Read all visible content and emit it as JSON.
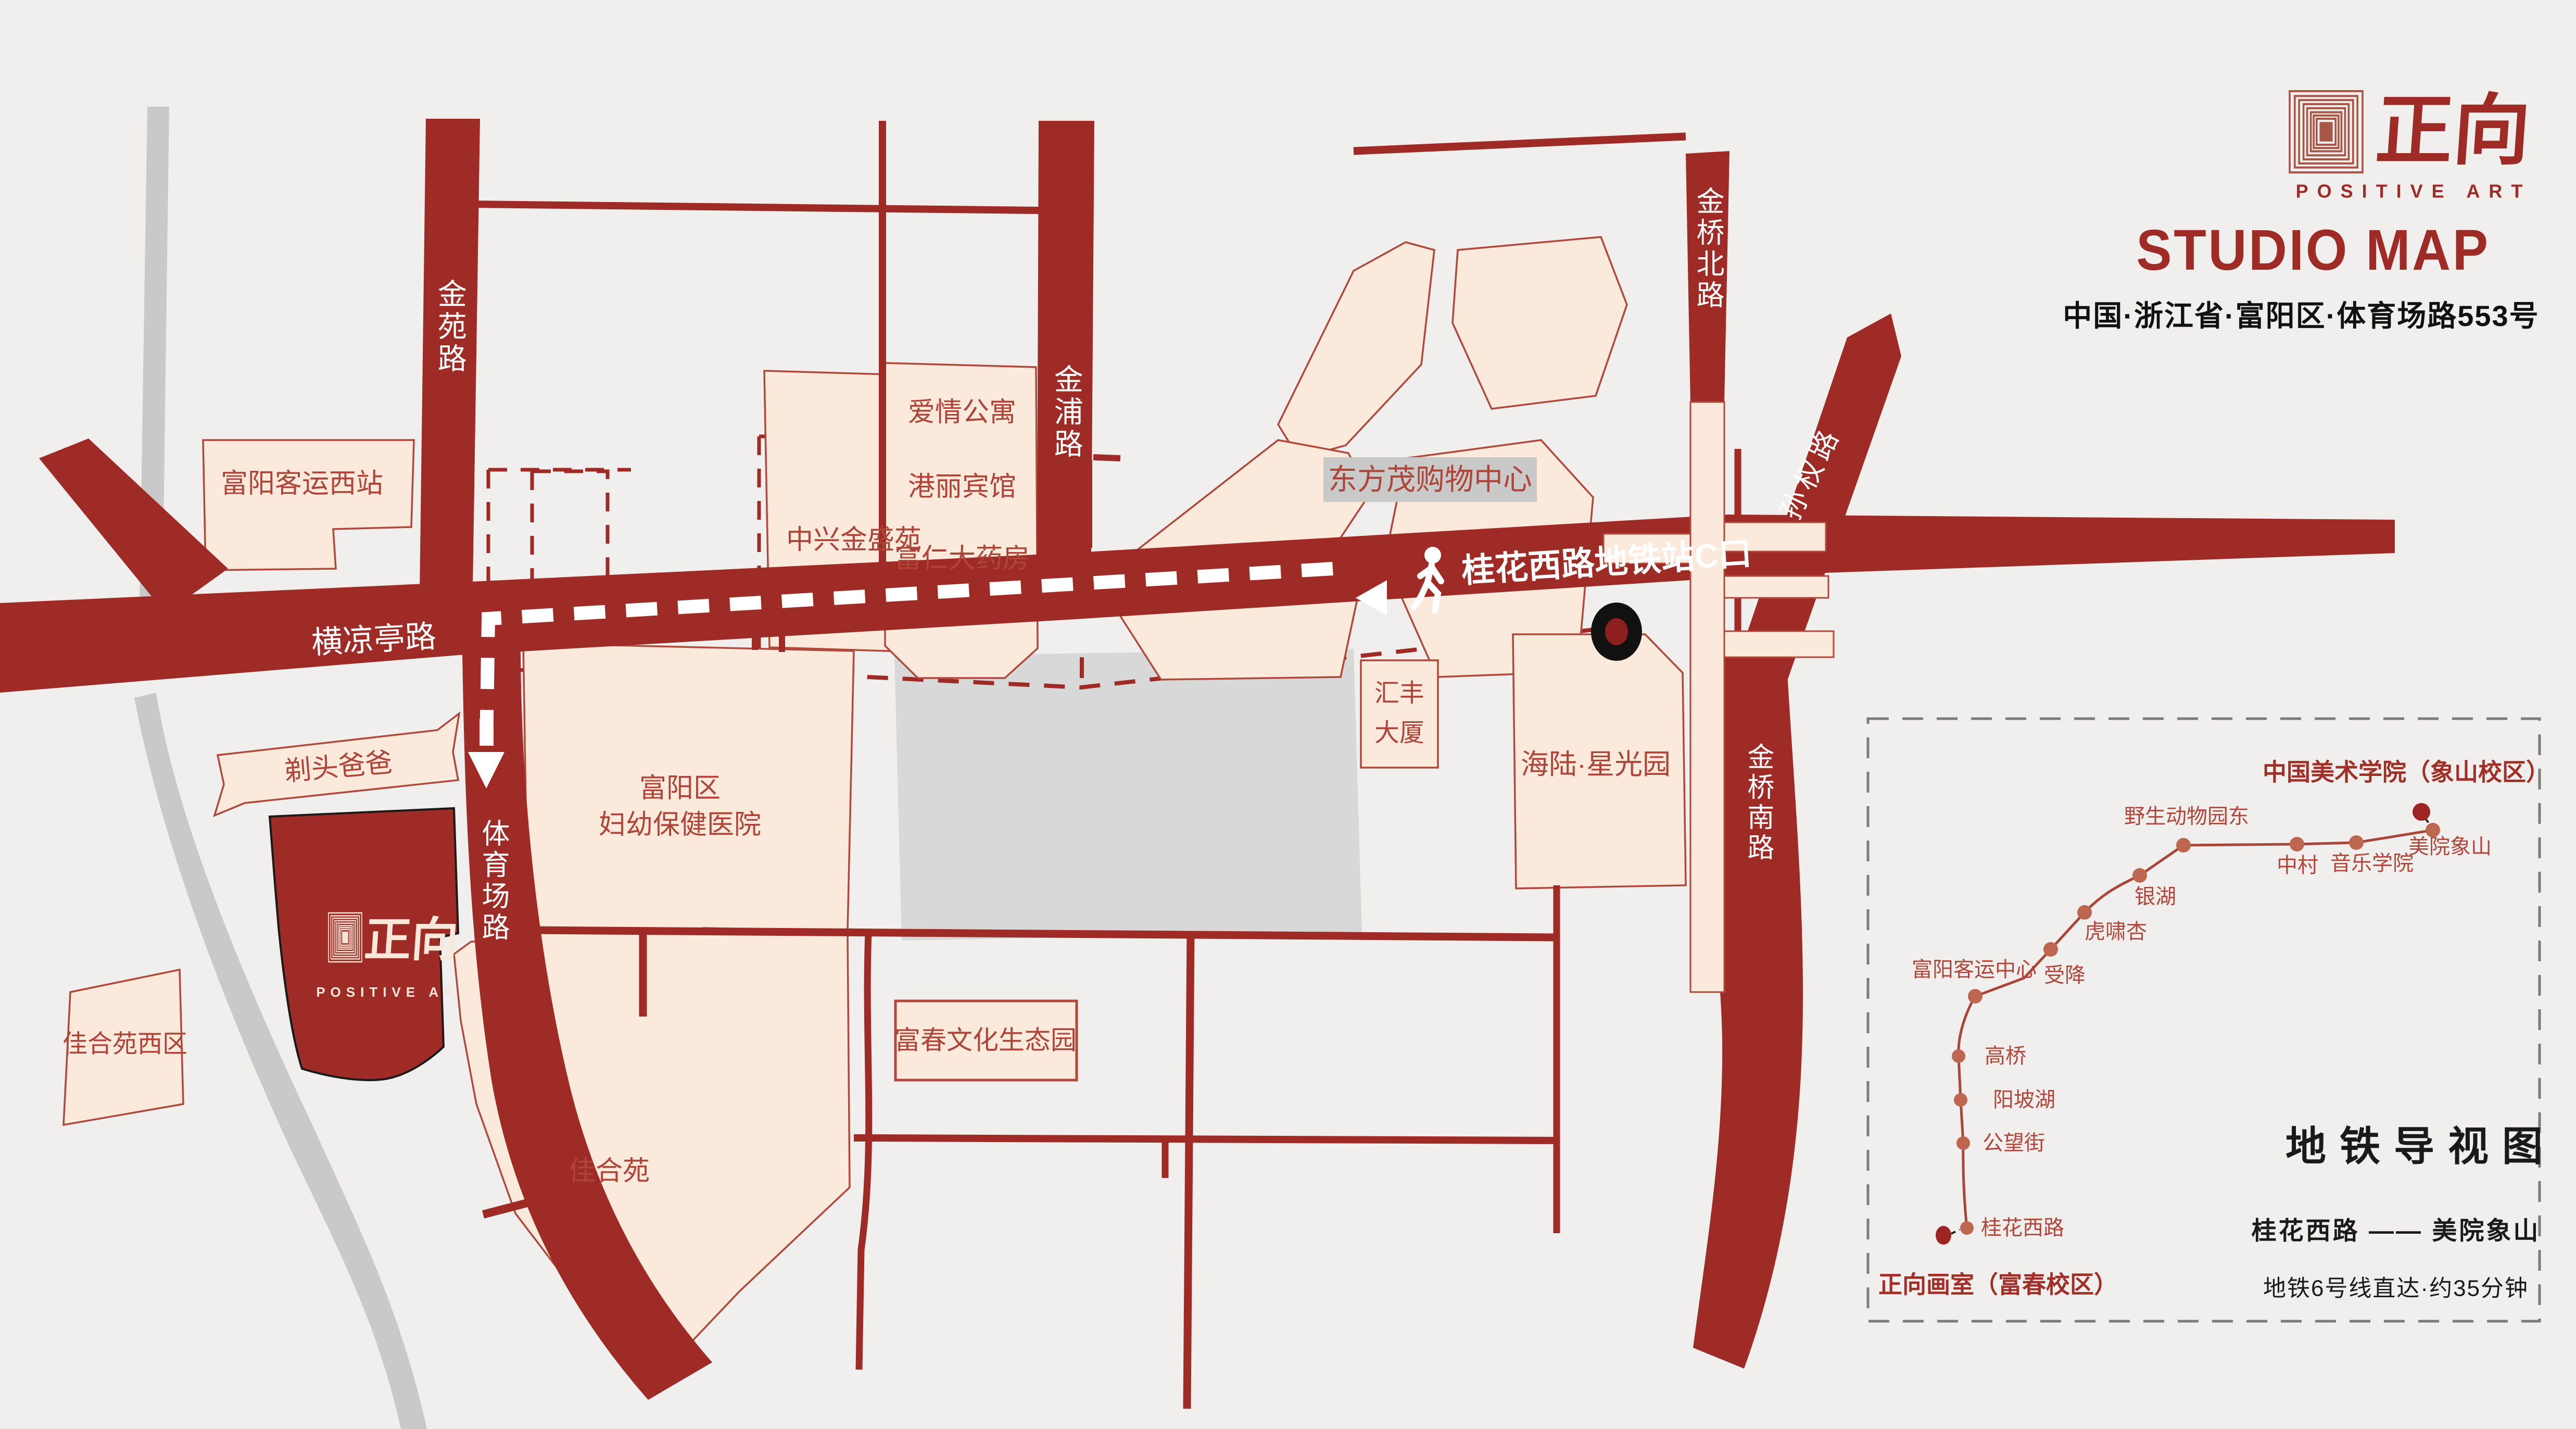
{
  "header": {
    "brand_cn": "正向",
    "brand_en": "POSITIVE ART",
    "title": "STUDIO MAP",
    "address": "中国·浙江省·富阳区·体育场路553号"
  },
  "colors": {
    "road": "#9e2b26",
    "building_fill": "#fbe9dc",
    "building_border": "#b0493c",
    "background": "#f0efee",
    "gray_road": "#c9c9c9",
    "label_red": "#ae4538",
    "metro_line": "#a8463a",
    "metro_dot": "#bd6751",
    "metro_big_dot": "#9e2423",
    "inset_border": "#7b7b7b"
  },
  "roads": {
    "jinyuan": "金苑路",
    "jinpu": "金浦路",
    "jinqiao_north": "金桥北路",
    "jinqiao_south": "金桥南路",
    "sunquan": "孙权路",
    "hengliangting": "横凉亭路",
    "tiyuchang": "体育场路",
    "station_exit": "桂花西路地铁站C口"
  },
  "buildings": {
    "bus_station_west": "富阳客运西站",
    "zhongxing": "中兴金盛苑",
    "apt1": "爱情公寓",
    "apt2": "港丽宾馆",
    "apt3": "富仁大药房",
    "dongfangmao": "东方茂购物中心",
    "huifeng_l1": "汇丰",
    "huifeng_l2": "大厦",
    "hailu": "海陆·星光园",
    "hospital_l1": "富阳区",
    "hospital_l2": "妇幼保健医院",
    "titou": "剃头爸爸",
    "jiaheyuan_west": "佳合苑西区",
    "jiaheyuan": "佳合苑",
    "fuchun_park": "富春文化生态园"
  },
  "studio": {
    "logo_cn": "正向",
    "logo_en": "POSITIVE ART"
  },
  "metro": {
    "title": "地铁导视图",
    "route": "桂花西路 —— 美院象山",
    "note": "地铁6号线直达·约35分钟",
    "start_label": "正向画室（富春校区）",
    "end_label": "中国美术学院（象山校区）",
    "stations": [
      "桂花西路",
      "公望街",
      "阳坡湖",
      "高桥",
      "富阳客运中心",
      "受降",
      "虎啸杏",
      "银湖",
      "野生动物园东",
      "中村",
      "音乐学院",
      "美院象山"
    ]
  }
}
